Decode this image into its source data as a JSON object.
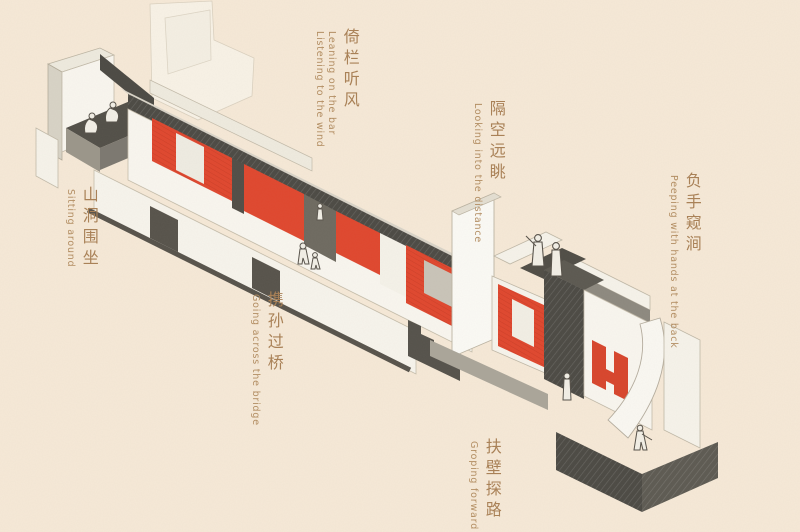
{
  "page": {
    "background_color": "#f6e9d7",
    "label_color": "#b0885c"
  },
  "palette": {
    "accent_red": "#e0472e",
    "ink_dark": "#4c4a44",
    "mid_gray": "#8d897f",
    "light_gray": "#cfcabf",
    "paper_white": "#faf8f2"
  },
  "labels": [
    {
      "id": "sitting-around",
      "zh": "山洞围坐",
      "en": [
        "Sitting around"
      ]
    },
    {
      "id": "leaning-listening",
      "zh": "倚栏听风",
      "en": [
        "Leaning on the bar",
        "Listening to the wind"
      ]
    },
    {
      "id": "looking-into-the-distance",
      "zh": "隔空远眺",
      "en": [
        "Looking into the distance"
      ]
    },
    {
      "id": "peeping-hands-at-back",
      "zh": "负手窥涧",
      "en": [
        "Peeping with hands at the back"
      ]
    },
    {
      "id": "going-across-the-bridge",
      "zh": "携孙过桥",
      "en": [
        "Going across the bridge"
      ]
    },
    {
      "id": "groping-forward",
      "zh": "扶壁探路",
      "en": [
        "Groping forward"
      ]
    }
  ],
  "figures": [
    {
      "name": "people-sitting-around-cave"
    },
    {
      "name": "pair-crossing-bridge"
    },
    {
      "name": "two-people-gazing-from-roof"
    },
    {
      "name": "person-standing-in-tower"
    },
    {
      "name": "person-groping-down-ramp"
    }
  ]
}
